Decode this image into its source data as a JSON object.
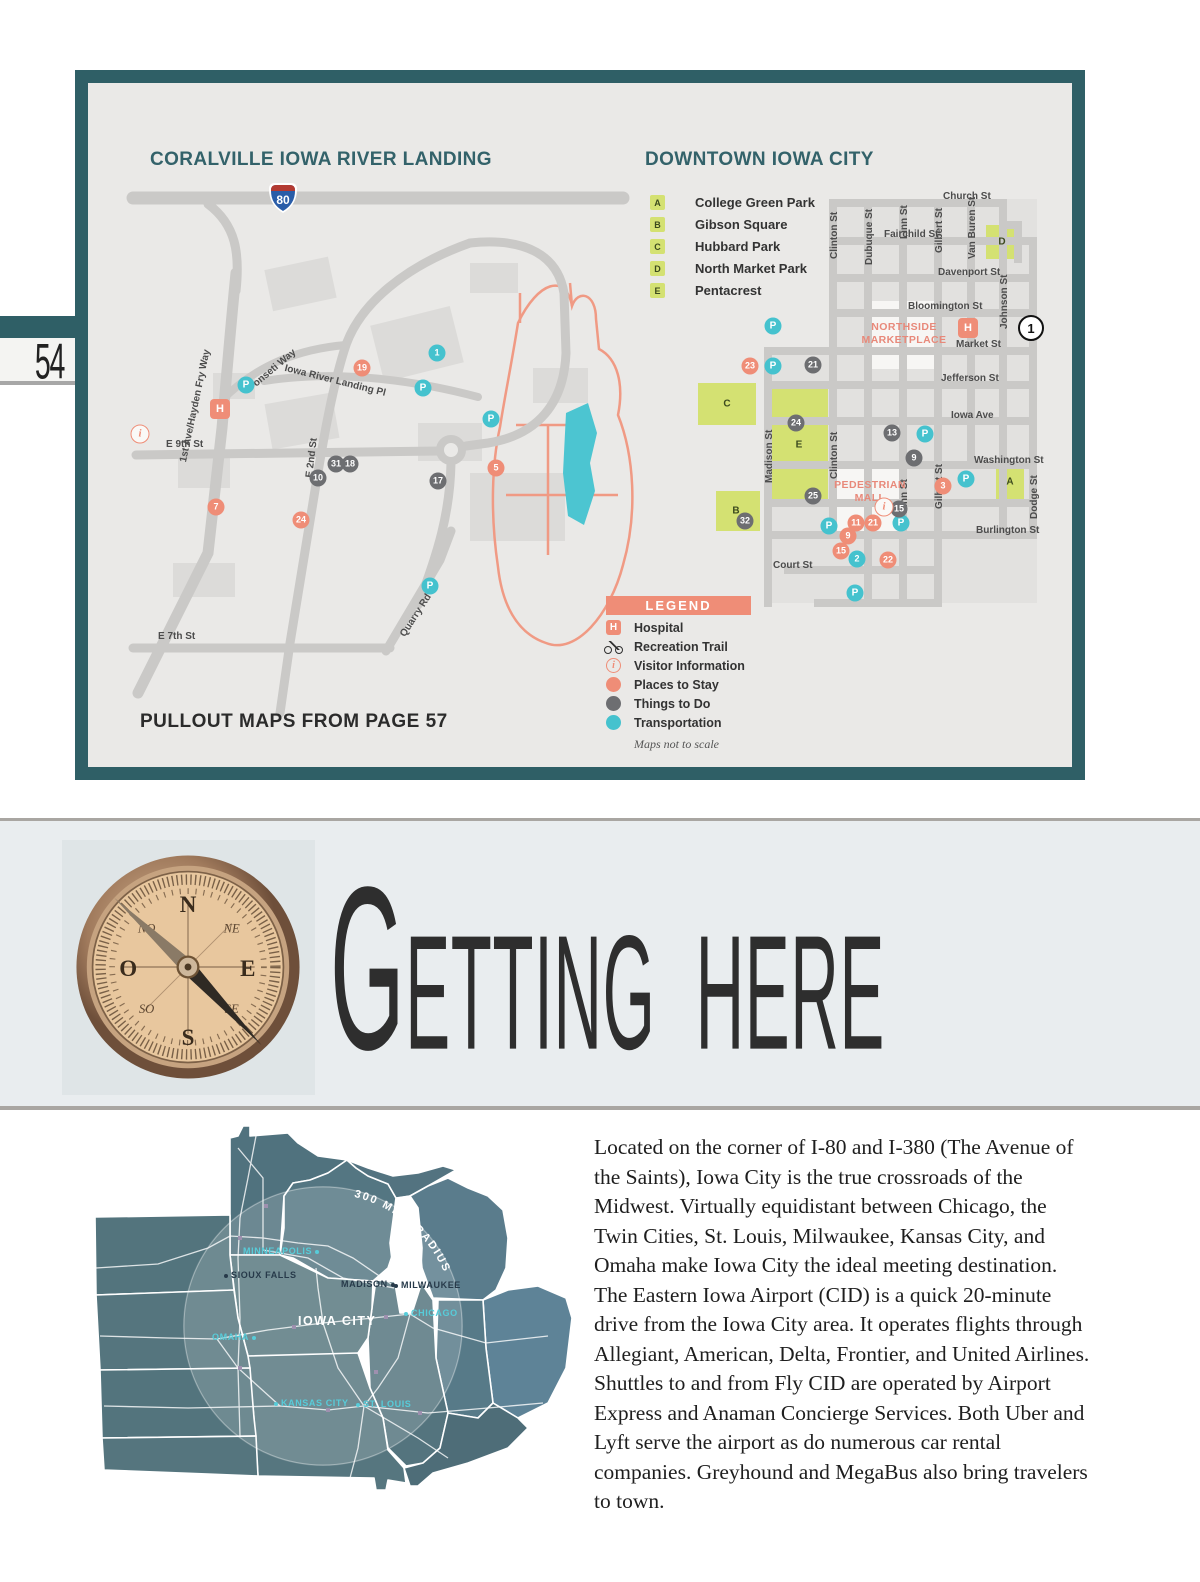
{
  "page": {
    "number": "54"
  },
  "map_panel": {
    "pullout_note": "PULLOUT MAPS FROM PAGE 57",
    "coralville": {
      "title": "CORALVILLE IOWA RIVER LANDING",
      "interstate_shield": "80",
      "streets": [
        {
          "t": "1st Ave/Hayden Fry Way",
          "x": 60,
          "y": 288,
          "rot": -78
        },
        {
          "t": "Ponseti Way",
          "x": 128,
          "y": 212,
          "rot": -40
        },
        {
          "t": "Iowa River Landing Pl",
          "x": 168,
          "y": 190,
          "rot": 14
        },
        {
          "t": "E 2nd St",
          "x": 186,
          "y": 304,
          "rot": -83
        },
        {
          "t": "E 9th St",
          "x": 48,
          "y": 266
        },
        {
          "t": "E 7th St",
          "x": 40,
          "y": 458
        },
        {
          "t": "Quarry Rd",
          "x": 280,
          "y": 460,
          "rot": -57
        }
      ],
      "markers": [
        {
          "t": "i",
          "c": "info",
          "x": 22,
          "y": 261
        },
        {
          "t": "H",
          "c": "hosp",
          "x": 102,
          "y": 236
        },
        {
          "t": "P",
          "c": "p",
          "x": 128,
          "y": 212
        },
        {
          "t": "19",
          "c": "stay",
          "x": 244,
          "y": 195
        },
        {
          "t": "1",
          "c": "trans",
          "x": 319,
          "y": 180
        },
        {
          "t": "P",
          "c": "p",
          "x": 305,
          "y": 215
        },
        {
          "t": "P",
          "c": "p",
          "x": 373,
          "y": 246
        },
        {
          "t": "5",
          "c": "stay",
          "x": 378,
          "y": 295
        },
        {
          "t": "17",
          "c": "todo",
          "x": 320,
          "y": 308
        },
        {
          "t": "31",
          "c": "todo",
          "x": 218,
          "y": 291
        },
        {
          "t": "18",
          "c": "todo",
          "x": 232,
          "y": 291
        },
        {
          "t": "10",
          "c": "todo",
          "x": 200,
          "y": 305
        },
        {
          "t": "7",
          "c": "stay",
          "x": 98,
          "y": 334
        },
        {
          "t": "24",
          "c": "stay",
          "x": 183,
          "y": 347
        },
        {
          "t": "P",
          "c": "p",
          "x": 312,
          "y": 413
        }
      ]
    },
    "downtown": {
      "title": "DOWNTOWN IOWA CITY",
      "parks": [
        {
          "key": "A",
          "label": "College Green Park"
        },
        {
          "key": "B",
          "label": "Gibson Square"
        },
        {
          "key": "C",
          "label": "Hubbard Park"
        },
        {
          "key": "D",
          "label": "North Market Park"
        },
        {
          "key": "E",
          "label": "Pentacrest"
        }
      ],
      "area_labels": [
        {
          "t": "NORTHSIDE\nMARKETPLACE",
          "x": 216,
          "y": 138
        },
        {
          "t": "PEDESTRIAN\nMALL",
          "x": 182,
          "y": 296
        }
      ],
      "streets": [
        {
          "t": "Church St",
          "x": 255,
          "y": 8
        },
        {
          "t": "Fairchild St",
          "x": 196,
          "y": 46
        },
        {
          "t": "Davenport St",
          "x": 250,
          "y": 84
        },
        {
          "t": "Bloomington St",
          "x": 220,
          "y": 118
        },
        {
          "t": "Market St",
          "x": 268,
          "y": 156
        },
        {
          "t": "Jefferson St",
          "x": 253,
          "y": 190
        },
        {
          "t": "Iowa Ave",
          "x": 263,
          "y": 227
        },
        {
          "t": "Washington St",
          "x": 286,
          "y": 272
        },
        {
          "t": "Burlington St",
          "x": 288,
          "y": 342
        },
        {
          "t": "Court St",
          "x": 85,
          "y": 377
        },
        {
          "t": "Clinton St",
          "x": 141,
          "y": 76,
          "rot": -90
        },
        {
          "t": "Dubuque St",
          "x": 176,
          "y": 82,
          "rot": -90
        },
        {
          "t": "Linn St",
          "x": 211,
          "y": 56,
          "rot": -90
        },
        {
          "t": "Gilbert St",
          "x": 246,
          "y": 70,
          "rot": -90
        },
        {
          "t": "Van Buren St",
          "x": 279,
          "y": 76,
          "rot": -90
        },
        {
          "t": "Johnson St",
          "x": 311,
          "y": 146,
          "rot": -90
        },
        {
          "t": "Madison St",
          "x": 76,
          "y": 300,
          "rot": -90
        },
        {
          "t": "Clinton St",
          "x": 141,
          "y": 296,
          "rot": -90
        },
        {
          "t": "Linn St",
          "x": 211,
          "y": 330,
          "rot": -90
        },
        {
          "t": "Gilbert St",
          "x": 246,
          "y": 326,
          "rot": -90
        },
        {
          "t": "Dodge St",
          "x": 341,
          "y": 336,
          "rot": -90
        }
      ],
      "markers": [
        {
          "t": "P",
          "c": "p",
          "x": 85,
          "y": 143
        },
        {
          "t": "H",
          "c": "hosp",
          "x": 280,
          "y": 145
        },
        {
          "t": "1",
          "c": "hwy",
          "x": 343,
          "y": 145
        },
        {
          "t": "23",
          "c": "stay",
          "x": 62,
          "y": 183
        },
        {
          "t": "P",
          "c": "p",
          "x": 85,
          "y": 183
        },
        {
          "t": "21",
          "c": "todo",
          "x": 125,
          "y": 182
        },
        {
          "t": "24",
          "c": "todo",
          "x": 108,
          "y": 240
        },
        {
          "t": "13",
          "c": "todo",
          "x": 204,
          "y": 250
        },
        {
          "t": "P",
          "c": "p",
          "x": 237,
          "y": 251
        },
        {
          "t": "9",
          "c": "todo",
          "x": 226,
          "y": 275
        },
        {
          "t": "3",
          "c": "stay",
          "x": 255,
          "y": 303
        },
        {
          "t": "P",
          "c": "p",
          "x": 278,
          "y": 296
        },
        {
          "t": "25",
          "c": "todo",
          "x": 125,
          "y": 313
        },
        {
          "t": "32",
          "c": "todo",
          "x": 57,
          "y": 338
        },
        {
          "t": "P",
          "c": "p",
          "x": 141,
          "y": 343
        },
        {
          "t": "11",
          "c": "stay",
          "x": 168,
          "y": 340
        },
        {
          "t": "21",
          "c": "stay",
          "x": 185,
          "y": 340
        },
        {
          "t": "P",
          "c": "p",
          "x": 213,
          "y": 340
        },
        {
          "t": "15",
          "c": "todo",
          "x": 211,
          "y": 326
        },
        {
          "t": "i",
          "c": "info",
          "x": 196,
          "y": 324
        },
        {
          "t": "9",
          "c": "stay",
          "x": 160,
          "y": 353
        },
        {
          "t": "15",
          "c": "stay",
          "x": 153,
          "y": 368
        },
        {
          "t": "2",
          "c": "trans",
          "x": 169,
          "y": 376
        },
        {
          "t": "22",
          "c": "stay",
          "x": 200,
          "y": 377
        },
        {
          "t": "P",
          "c": "p",
          "x": 167,
          "y": 410
        },
        {
          "t": "A",
          "c": "plab",
          "x": 322,
          "y": 299
        },
        {
          "t": "B",
          "c": "plab",
          "x": 48,
          "y": 328
        },
        {
          "t": "C",
          "c": "plab",
          "x": 39,
          "y": 221
        },
        {
          "t": "D",
          "c": "plab",
          "x": 314,
          "y": 59
        },
        {
          "t": "E",
          "c": "plab",
          "x": 111,
          "y": 262
        }
      ]
    },
    "legend": {
      "title": "LEGEND",
      "items": [
        {
          "icon": "hospital",
          "label": "Hospital"
        },
        {
          "icon": "bike",
          "label": "Recreation Trail"
        },
        {
          "icon": "info",
          "label": "Visitor Information"
        },
        {
          "icon": "stay",
          "label": "Places to Stay"
        },
        {
          "icon": "todo",
          "label": "Things to Do"
        },
        {
          "icon": "trans",
          "label": "Transportation"
        }
      ],
      "note": "Maps not to scale"
    }
  },
  "getting_here": {
    "title": "Getting Here"
  },
  "intro": {
    "text": "Located on the corner of I-80 and I-380 (The Avenue of the Saints), Iowa City is the true crossroads of the Midwest. Virtually equidistant between Chicago, the Twin Cities, St. Louis, Milwaukee, Kansas City, and Omaha make Iowa City the ideal meeting destination. The Eastern Iowa Airport (CID) is a quick 20-minute drive from the Iowa City area. It operates flights through Allegiant, American, Delta, Frontier, and United Airlines. Shuttles to and from Fly CID are operated by Airport Express and Anaman Concierge Services. Both Uber and Lyft serve the airport as do numerous car rental companies. Greyhound and MegaBus also bring travelers to town."
  },
  "midwest_map": {
    "radius_label": "300 MILE RADIUS",
    "cities": [
      {
        "t": "MINNEAPOLIS",
        "c": "cyan dr",
        "x": 155,
        "y": 128
      },
      {
        "t": "SIOUX FALLS",
        "c": "dark dl",
        "x": 136,
        "y": 152
      },
      {
        "t": "MADISON",
        "c": "dark dr",
        "x": 253,
        "y": 161
      },
      {
        "t": "MILWAUKEE",
        "c": "dark dl",
        "x": 306,
        "y": 162
      },
      {
        "t": "CHICAGO",
        "c": "cyan dl",
        "x": 316,
        "y": 190
      },
      {
        "t": "IOWA CITY",
        "c": "white big",
        "x": 210,
        "y": 196
      },
      {
        "t": "OMAHA",
        "c": "cyan dr",
        "x": 124,
        "y": 214
      },
      {
        "t": "KANSAS CITY",
        "c": "cyan dl",
        "x": 186,
        "y": 280
      },
      {
        "t": "ST. LOUIS",
        "c": "cyan dl",
        "x": 268,
        "y": 281
      }
    ]
  },
  "colors": {
    "frame_teal": "#2f5f66",
    "salmon": "#ef8d77",
    "teal_marker": "#45c2ce",
    "gray_marker": "#6d6e71",
    "park_green": "#d4e172",
    "midwest_base": "#547682",
    "cyan_label": "#57ccd9"
  }
}
